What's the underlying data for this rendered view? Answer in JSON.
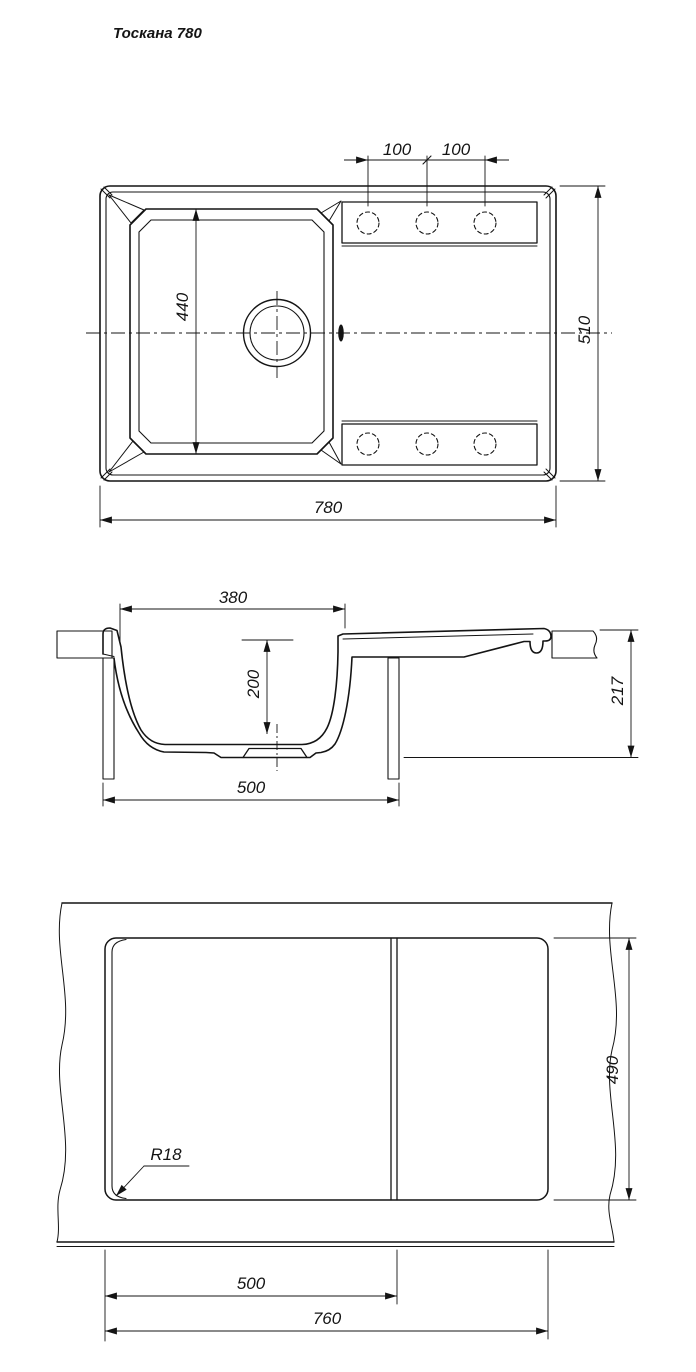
{
  "title": "Тоскана 780",
  "colors": {
    "line": "#141414",
    "background": "#ffffff"
  },
  "top_view": {
    "dim_faucet_spacing_left": "100",
    "dim_faucet_spacing_right": "100",
    "dim_bowl_length": "440",
    "dim_overall_depth": "510",
    "dim_overall_width": "780"
  },
  "section_view": {
    "dim_bowl_top_width": "380",
    "dim_bowl_depth": "200",
    "dim_base_width": "500",
    "dim_overall_height": "217"
  },
  "cutout_view": {
    "dim_corner_radius": "R18",
    "dim_bowl_cutout_width": "500",
    "dim_cutout_width": "760",
    "dim_cutout_height": "490"
  }
}
